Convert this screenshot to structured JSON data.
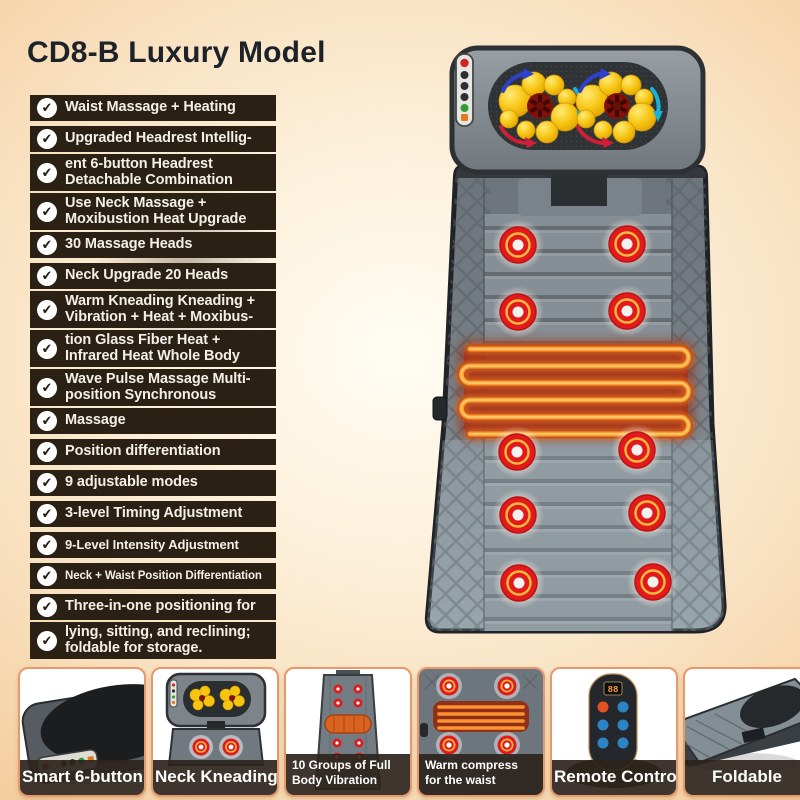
{
  "page": {
    "title": "CD8-B Luxury Model"
  },
  "colors": {
    "background_peach": "#f5d2a4",
    "feature_strip": "#2a2013",
    "check_circle": "#ffffff",
    "card_border_orange": "#e6996b",
    "caption_bar": "#2c241c",
    "massage_node_red": "#e11b1b",
    "node_ring_orange": "#ffb840",
    "heat_coil_orange": "#ff9d2e",
    "kneading_ball_yellow": "#f6c50f",
    "mat_gray": "#7d868d"
  },
  "features": [
    {
      "rows": [
        {
          "lines": [
            "Waist Massage + Heating"
          ]
        }
      ]
    },
    {
      "rows": [
        {
          "lines": [
            "Upgraded Headrest Intellig-"
          ]
        },
        {
          "lines": [
            "ent 6-button Headrest",
            "Detachable Combination"
          ]
        },
        {
          "lines": [
            "Use Neck Massage +",
            "Moxibustion Heat Upgrade"
          ]
        },
        {
          "lines": [
            "30 Massage Heads"
          ]
        }
      ]
    },
    {
      "rows": [
        {
          "lines": [
            "Neck Upgrade 20 Heads"
          ]
        },
        {
          "lines": [
            "Warm Kneading Kneading +",
            "Vibration + Heat + Moxibus-"
          ]
        },
        {
          "lines": [
            "tion Glass Fiber Heat +",
            "Infrared Heat Whole Body"
          ]
        },
        {
          "lines": [
            "Wave Pulse Massage Multi-",
            "position Synchronous"
          ]
        },
        {
          "lines": [
            "Massage"
          ]
        }
      ]
    },
    {
      "rows": [
        {
          "lines": [
            "Position differentiation"
          ]
        }
      ]
    },
    {
      "rows": [
        {
          "lines": [
            "9 adjustable modes"
          ]
        }
      ]
    },
    {
      "rows": [
        {
          "lines": [
            "3-level Timing Adjustment"
          ]
        }
      ]
    },
    {
      "size": "small",
      "rows": [
        {
          "lines": [
            "9-Level Intensity Adjustment"
          ]
        }
      ]
    },
    {
      "size": "xsmall",
      "rows": [
        {
          "lines": [
            "Neck + Waist Position Differentiation"
          ]
        }
      ]
    },
    {
      "rows": [
        {
          "lines": [
            "Three-in-one positioning for"
          ]
        },
        {
          "lines": [
            "lying, sitting, and reclining;",
            "foldable for storage."
          ]
        }
      ]
    }
  ],
  "thumbnails": [
    {
      "label": "Smart 6-button"
    },
    {
      "label": "Neck Kneading"
    },
    {
      "label": "10 Groups of Full Body Vibration"
    },
    {
      "label": "Warm compress for the waist"
    },
    {
      "label": "Remote Control",
      "screen": "88"
    },
    {
      "label": "Foldable"
    }
  ]
}
